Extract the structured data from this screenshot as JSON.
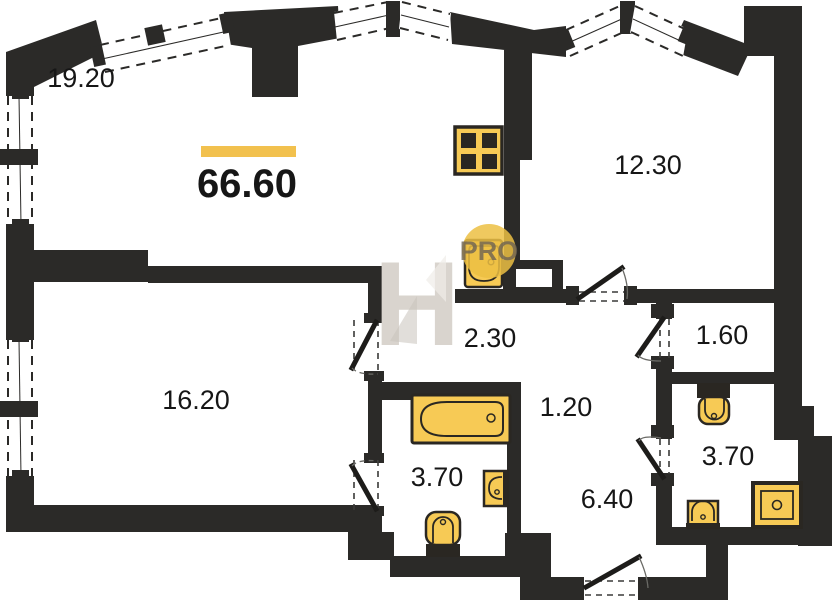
{
  "plan": {
    "total_area": {
      "value": "66.60"
    },
    "rooms": [
      {
        "id": "room-top-left",
        "label": "19.20"
      },
      {
        "id": "room-top-right",
        "label": "12.30"
      },
      {
        "id": "room-left",
        "label": "16.20"
      },
      {
        "id": "corridor",
        "label": "2.30"
      },
      {
        "id": "wardrobe",
        "label": "1.60"
      },
      {
        "id": "niche",
        "label": "1.20"
      },
      {
        "id": "bathroom-middle",
        "label": "3.70"
      },
      {
        "id": "hallway",
        "label": "6.40"
      },
      {
        "id": "bathroom-right",
        "label": "3.70"
      }
    ],
    "watermark": {
      "logo": "H",
      "badge": "PRO"
    },
    "fixtures": [
      "stove",
      "toilet",
      "bathtub",
      "sink",
      "shower"
    ],
    "colors": {
      "wall": "#2b2a28",
      "fixture_fill": "#f7ca55",
      "fixture_stroke": "#2a2722",
      "accent_bar": "#f2c14e",
      "watermark_gray": "#d9d4ce",
      "pro_circle": "#ecc043",
      "pro_text": "#6e6353",
      "label": "#161616"
    }
  }
}
